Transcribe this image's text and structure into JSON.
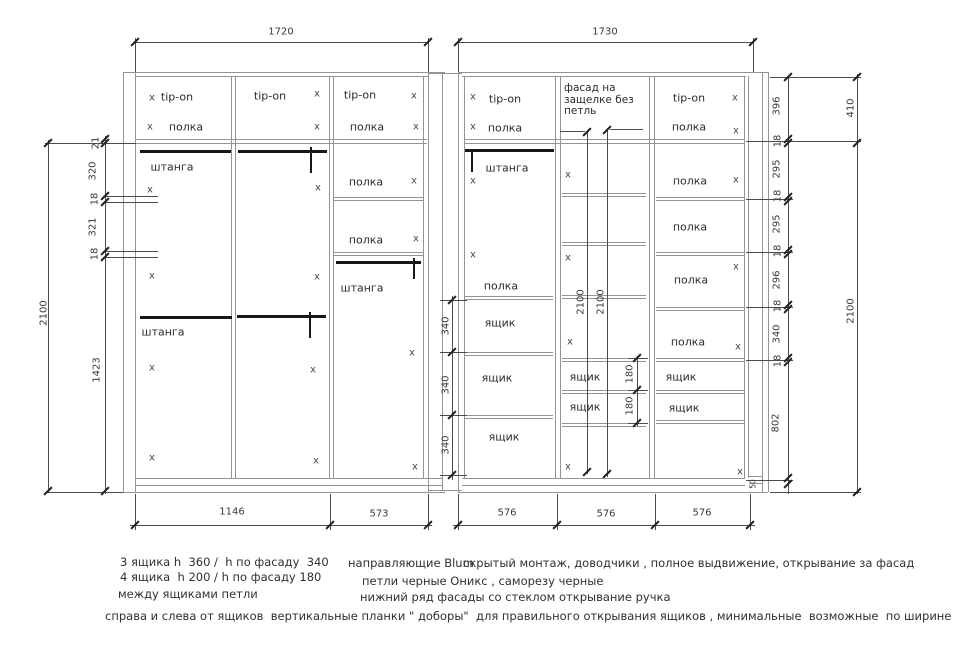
{
  "drawing_title": "wardrobe-sections-technical-drawing",
  "colors": {
    "cabinet_line": "#949494",
    "dimension_line": "#4c4c4c",
    "rod": "#171717",
    "text": "#2b2b2b"
  },
  "drawing": {
    "x_mark_glyph": "x",
    "dim_labels": [
      {
        "t": "1720",
        "x": 281,
        "y": 32,
        "v": false
      },
      {
        "t": "1730",
        "x": 605,
        "y": 32,
        "v": false
      },
      {
        "t": "1146",
        "x": 232,
        "y": 512,
        "v": false
      },
      {
        "t": "573",
        "x": 379,
        "y": 514,
        "v": false
      },
      {
        "t": "576",
        "x": 507,
        "y": 513,
        "v": false
      },
      {
        "t": "576",
        "x": 606,
        "y": 514,
        "v": false
      },
      {
        "t": "576",
        "x": 702,
        "y": 513,
        "v": false
      },
      {
        "t": "21",
        "x": 96,
        "y": 143,
        "v": true
      },
      {
        "t": "320",
        "x": 93,
        "y": 171,
        "v": true
      },
      {
        "t": "18",
        "x": 95,
        "y": 199,
        "v": true
      },
      {
        "t": "321",
        "x": 93,
        "y": 227,
        "v": true
      },
      {
        "t": "18",
        "x": 95,
        "y": 254,
        "v": true
      },
      {
        "t": "1423",
        "x": 97,
        "y": 370,
        "v": true
      },
      {
        "t": "2100",
        "x": 44,
        "y": 313,
        "v": true
      },
      {
        "t": "340",
        "x": 446,
        "y": 326,
        "v": true
      },
      {
        "t": "340",
        "x": 446,
        "y": 385,
        "v": true
      },
      {
        "t": "340",
        "x": 446,
        "y": 445,
        "v": true
      },
      {
        "t": "2100",
        "x": 581,
        "y": 302,
        "v": true
      },
      {
        "t": "2100",
        "x": 601,
        "y": 302,
        "v": true
      },
      {
        "t": "180",
        "x": 630,
        "y": 374,
        "v": true
      },
      {
        "t": "180",
        "x": 630,
        "y": 406,
        "v": true
      },
      {
        "t": "396",
        "x": 777,
        "y": 106,
        "v": true
      },
      {
        "t": "18",
        "x": 778,
        "y": 141,
        "v": true
      },
      {
        "t": "295",
        "x": 777,
        "y": 169,
        "v": true
      },
      {
        "t": "18",
        "x": 778,
        "y": 196,
        "v": true
      },
      {
        "t": "295",
        "x": 777,
        "y": 224,
        "v": true
      },
      {
        "t": "18",
        "x": 778,
        "y": 251,
        "v": true
      },
      {
        "t": "296",
        "x": 777,
        "y": 280,
        "v": true
      },
      {
        "t": "18",
        "x": 778,
        "y": 306,
        "v": true
      },
      {
        "t": "340",
        "x": 777,
        "y": 334,
        "v": true
      },
      {
        "t": "18",
        "x": 778,
        "y": 361,
        "v": true
      },
      {
        "t": "802",
        "x": 776,
        "y": 423,
        "v": true
      },
      {
        "t": "50",
        "x": 753,
        "y": 484,
        "v": true,
        "s": true
      },
      {
        "t": "410",
        "x": 851,
        "y": 108,
        "v": true
      },
      {
        "t": "2100",
        "x": 851,
        "y": 311,
        "v": true
      }
    ],
    "part_labels": [
      {
        "t": "tip-on",
        "x": 177,
        "y": 97
      },
      {
        "t": "полка",
        "x": 186,
        "y": 127
      },
      {
        "t": "tip-on",
        "x": 270,
        "y": 96
      },
      {
        "t": "tip-on",
        "x": 360,
        "y": 95
      },
      {
        "t": "полка",
        "x": 367,
        "y": 127
      },
      {
        "t": "штанга",
        "x": 172,
        "y": 167
      },
      {
        "t": "полка",
        "x": 366,
        "y": 182
      },
      {
        "t": "полка",
        "x": 366,
        "y": 240
      },
      {
        "t": "штанга",
        "x": 362,
        "y": 288
      },
      {
        "t": "штанга",
        "x": 163,
        "y": 332
      },
      {
        "t": "tip-on",
        "x": 505,
        "y": 99
      },
      {
        "t": "полка",
        "x": 505,
        "y": 128
      },
      {
        "t": "штанга",
        "x": 507,
        "y": 168
      },
      {
        "t": "полка",
        "x": 501,
        "y": 286
      },
      {
        "t": "ящик",
        "x": 500,
        "y": 323
      },
      {
        "t": "ящик",
        "x": 497,
        "y": 378
      },
      {
        "t": "ящик",
        "x": 504,
        "y": 437
      },
      {
        "t": "ящик",
        "x": 585,
        "y": 377
      },
      {
        "t": "ящик",
        "x": 585,
        "y": 407
      },
      {
        "t": "tip-on",
        "x": 689,
        "y": 98
      },
      {
        "t": "полка",
        "x": 689,
        "y": 127
      },
      {
        "t": "полка",
        "x": 690,
        "y": 181
      },
      {
        "t": "полка",
        "x": 690,
        "y": 227
      },
      {
        "t": "полка",
        "x": 691,
        "y": 280
      },
      {
        "t": "полка",
        "x": 688,
        "y": 342
      },
      {
        "t": "ящик",
        "x": 681,
        "y": 377
      },
      {
        "t": "ящик",
        "x": 684,
        "y": 408
      }
    ],
    "facade_label": {
      "lines": [
        "фасад на",
        "защелке без",
        "петль"
      ],
      "x": 564,
      "y": 83
    },
    "x_marks": [
      [
        152,
        98
      ],
      [
        150,
        127
      ],
      [
        317,
        94
      ],
      [
        317,
        127
      ],
      [
        414,
        96
      ],
      [
        416,
        127
      ],
      [
        150,
        190
      ],
      [
        152,
        276
      ],
      [
        152,
        368
      ],
      [
        152,
        458
      ],
      [
        318,
        188
      ],
      [
        317,
        277
      ],
      [
        313,
        370
      ],
      [
        316,
        461
      ],
      [
        414,
        181
      ],
      [
        416,
        239
      ],
      [
        412,
        353
      ],
      [
        415,
        467
      ],
      [
        473,
        97
      ],
      [
        473,
        127
      ],
      [
        473,
        181
      ],
      [
        473,
        255
      ],
      [
        568,
        175
      ],
      [
        568,
        258
      ],
      [
        570,
        342
      ],
      [
        568,
        467
      ],
      [
        735,
        98
      ],
      [
        736,
        131
      ],
      [
        736,
        180
      ],
      [
        736,
        267
      ],
      [
        738,
        347
      ],
      [
        740,
        472
      ]
    ]
  },
  "notes": [
    {
      "text": "3 ящика h  360 /  h по фасаду  340",
      "x": 120,
      "y": 555
    },
    {
      "text": "4 ящика  h 200 / h по фасаду 180",
      "x": 120,
      "y": 570
    },
    {
      "text": "между ящиками петли",
      "x": 118,
      "y": 587
    },
    {
      "text": "направляющие Blum",
      "x": 348,
      "y": 556
    },
    {
      "text": "скрытый монтаж, доводчики , полное выдвижение, открывание за фасад",
      "x": 463,
      "y": 556
    },
    {
      "text": "петли черные Оникс , саморезу черные",
      "x": 362,
      "y": 574
    },
    {
      "text": "нижний ряд фасады со стеклом открывание ручка",
      "x": 360,
      "y": 590
    },
    {
      "text": "справа и слева от ящиков  вертикальные планки \" доборы\"  для правильного открывания ящиков , минимальные  возможные  по ширине",
      "x": 105,
      "y": 609
    }
  ]
}
